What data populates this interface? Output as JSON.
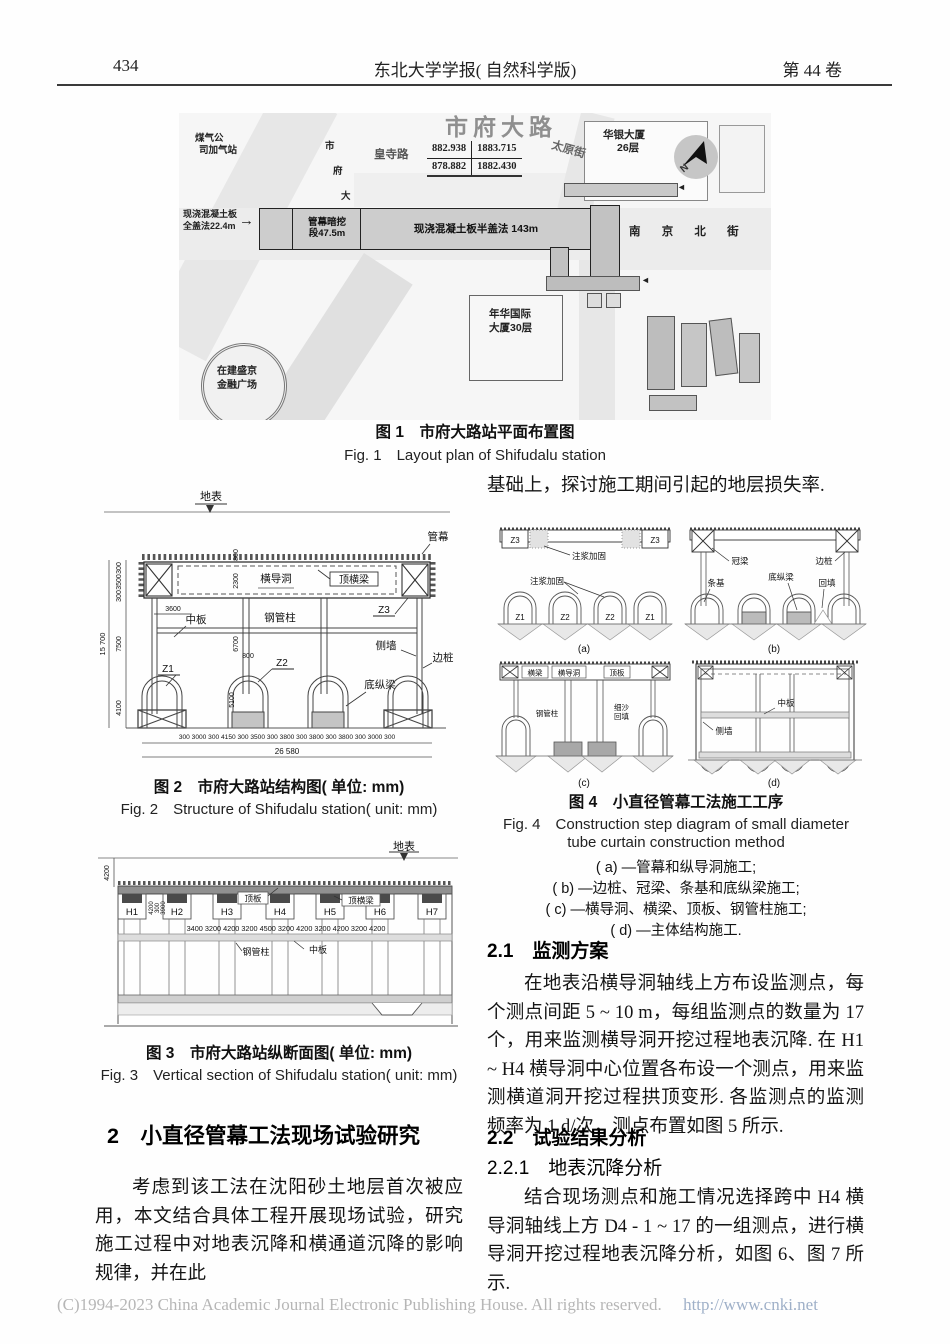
{
  "header": {
    "page_number": "434",
    "journal_title": "东北大学学报( 自然科学版)",
    "volume": "第 44 卷"
  },
  "fig1": {
    "caption_zh": "图 1　市府大路站平面布置图",
    "caption_en": "Fig. 1　Layout plan of Shifudalu station",
    "map": {
      "gas_station_l1": "煤气公",
      "gas_station_l2": "司加气站",
      "shifu_chars": [
        "市",
        "府",
        "大",
        "路"
      ],
      "huangsi_road": "皇寺路",
      "shifu_big": "市府大路",
      "coords": {
        "r1c1": "882.938",
        "r1c2": "1883.715",
        "r2c1": "878.882",
        "r2c2": "1882.430"
      },
      "taiyuan_street": "太原街",
      "huayin_l1": "华银大厦",
      "huayin_l2": "26层",
      "north": "N",
      "full_cover_l1": "现浇混凝土板",
      "full_cover_l2": "全盖法22.4m",
      "arrow": "→",
      "arrow_left": "◄",
      "tube_seg_l1": "管幕暗挖",
      "tube_seg_l2": "段47.5m",
      "half_cover": "现浇混凝土板半盖法 143m",
      "nanjing_street": "南 京 北 街",
      "nianhua_l1": "年华国际",
      "nianhua_l2": "大厦30层",
      "shengjing_l1": "在建盛京",
      "shengjing_l2": "金融广场"
    }
  },
  "fig2": {
    "caption_zh": "图 2　市府大路站结构图( 单位: mm)",
    "caption_en": "Fig. 2　Structure of Shifudalu station( unit: mm)",
    "labels": {
      "surface": "地表",
      "curtain": "管幕",
      "cross_tunnel": "横导洞",
      "top_beam": "顶横梁",
      "mid_slab": "中板",
      "steel_col": "钢管柱",
      "z1": "Z1",
      "z2": "Z2",
      "z3": "Z3",
      "side_wall": "侧墙",
      "side_pile": "边桩",
      "bottom_beam": "底纵梁"
    },
    "dims": {
      "total_height": "15 700",
      "h1": "300",
      "h2": "3500",
      "h3": "300",
      "h4": "7500",
      "h5": "4100",
      "d3600": "3600",
      "d800a": "800",
      "d2300": "2300",
      "d6700": "6700",
      "d800b": "800",
      "d5100": "5100",
      "bottom_row": "300 3000 300  4150  300 3500 300  3800  300 3800 300 3800 300 3000 300",
      "total_width": "26 580"
    }
  },
  "fig3": {
    "caption_zh": "图 3　市府大路站纵断面图( 单位: mm)",
    "caption_en": "Fig. 3　Vertical section of Shifudalu station( unit: mm)",
    "labels": {
      "surface": "地表",
      "top_slab": "顶板",
      "top_beam": "顶横梁",
      "steel_col": "钢管柱",
      "mid_slab": "中板",
      "h": [
        "H1",
        "H2",
        "H3",
        "H4",
        "H5",
        "H6",
        "H7"
      ]
    },
    "dims": {
      "depth": "4200",
      "s1": "4200",
      "s2": "300",
      "s3": "3900",
      "row": "3400 3200  4200  3200  4500  3200  4200  3200  4200  3200  4200"
    }
  },
  "fig4": {
    "caption_zh": "图 4　小直径管幕工法施工工序",
    "caption_en1": "Fig. 4　Construction step diagram of small diameter",
    "caption_en2": "tube curtain construction method",
    "notes": [
      "( a) —管幕和纵导洞施工;",
      "( b) —边桩、冠梁、条基和底纵梁施工;",
      "( c) —横导洞、横梁、顶板、钢管柱施工;",
      "( d) —主体结构施工."
    ],
    "a": {
      "z3": "Z3",
      "grout": "注浆加固",
      "z1": "Z1",
      "z2": "Z2",
      "tag": "(a)"
    },
    "b": {
      "crown": "冠梁",
      "pile": "边桩",
      "strip": "条基",
      "bottom_beam": "底纵梁",
      "backfill": "回填",
      "tag": "(b)"
    },
    "c": {
      "beam": "横梁",
      "tunnel": "横导洞",
      "slab": "顶板",
      "col": "钢管柱",
      "sand1": "细沙",
      "sand2": "回填",
      "tag": "(c)"
    },
    "d": {
      "mid": "中板",
      "wall": "侧墙",
      "tag": "(d)"
    }
  },
  "body": {
    "right_top": "基础上，探讨施工期间引起的地层损失率.",
    "sec2_heading": "2　小直径管幕工法现场试验研究",
    "sec2_para": "考虑到该工法在沈阳砂土地层首次被应用，本文结合具体工程开展现场试验，研究施工过程中对地表沉降和横通道沉降的影响规律，并在此",
    "sec21_heading": "2.1　监测方案",
    "sec21_para": "在地表沿横导洞轴线上方布设监测点，每个测点间距 5 ~ 10 m，每组监测点的数量为 17 个，用来监测横导洞开挖过程地表沉降. 在 H1 ~ H4 横导洞中心位置各布设一个测点，用来监测横道洞开挖过程拱顶变形. 各监测点的监测频率为 1 d/次，测点布置如图 5 所示.",
    "sec22_heading": "2.2　试验结果分析",
    "sec221_heading": "2.2.1　地表沉降分析",
    "sec221_para": "结合现场测点和施工情况选择跨中 H4 横导洞轴线上方 D4 - 1 ~ 17 的一组测点，进行横导洞开挖过程地表沉降分析，如图 6、图 7 所示."
  },
  "footer": {
    "copyright": "(C)1994-2023 China Academic Journal Electronic Publishing House. All rights reserved.",
    "url": "http://www.cnki.net"
  }
}
